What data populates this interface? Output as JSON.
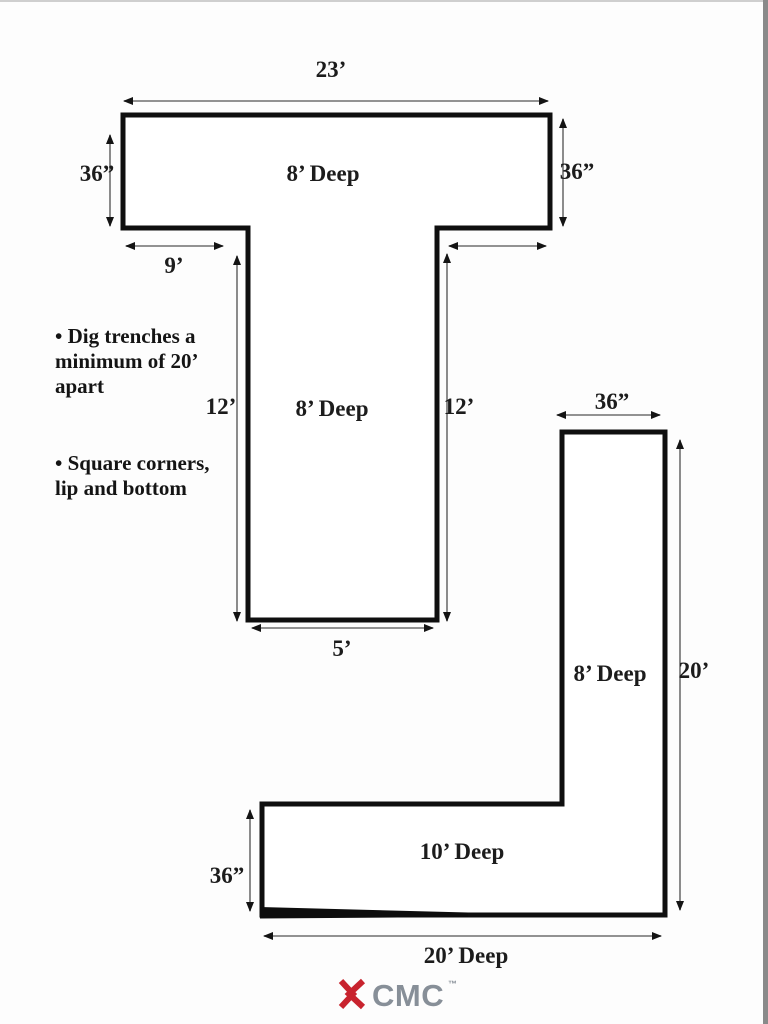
{
  "page": {
    "background": "#fdfdfd",
    "top_edge_color": "#cfcfcf",
    "right_edge_color": "#8a8a8a",
    "line_color": "#0f0f0f",
    "dimension_line_color": "#6f6f6f"
  },
  "notes": {
    "bullet1": "• Dig trenches a\nminimum of 20’\napart",
    "bullet2": "• Square corners,\nlip and bottom"
  },
  "t_trench": {
    "top_width_label": "23’",
    "left_depth_label": "36”",
    "right_depth_label": "36”",
    "bar_deep_label": "8’ Deep",
    "left_lip_label": "9’",
    "stem_left_length_label": "12’",
    "stem_right_length_label": "12’",
    "stem_deep_label": "8’ Deep",
    "stem_width_label": "5’"
  },
  "l_trench": {
    "top_width_label": "36”",
    "right_length_label": "20’",
    "vertical_deep_label": "8’ Deep",
    "horizontal_deep_label": "10’ Deep",
    "left_width_label": "36”",
    "bottom_length_label": "20’ Deep"
  },
  "logo": {
    "text": "CMC",
    "trademark": "™",
    "mark_color": "#c8232e",
    "text_color": "#878f98"
  }
}
